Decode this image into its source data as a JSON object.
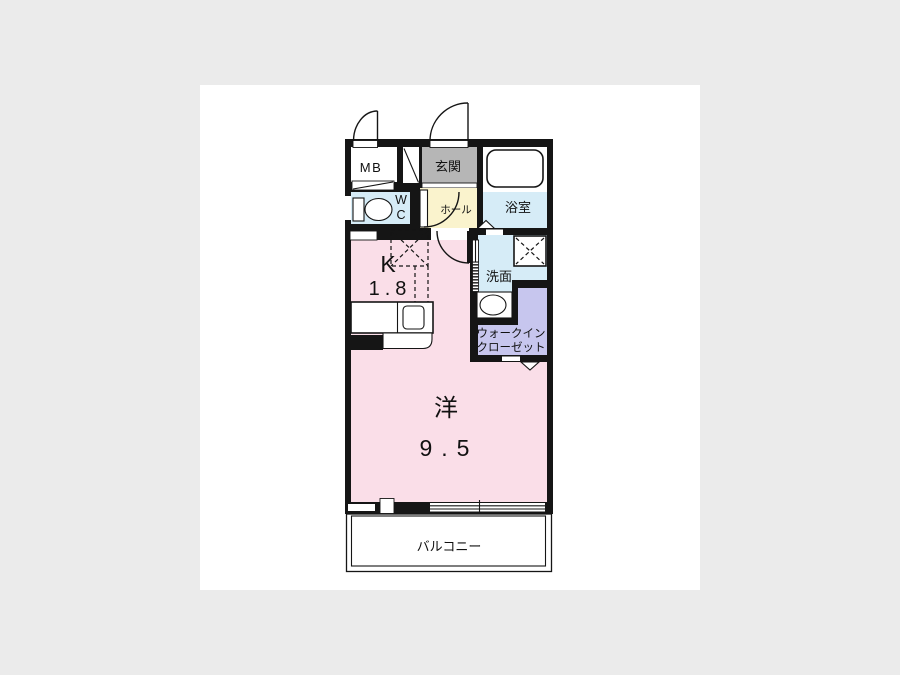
{
  "floorplan": {
    "labels": {
      "mb": "MB",
      "entrance": "玄関",
      "bathroom": "浴室",
      "toilet_line1": "W",
      "toilet_line2": "C",
      "hall": "ホール",
      "washroom": "洗面",
      "walk_in_closet_line1": "ウォークイン",
      "walk_in_closet_line2": "クローゼット",
      "kitchen": "K",
      "kitchen_size": "1.8",
      "western_room": "洋",
      "western_room_size": "9.5",
      "balcony": "バルコニー"
    },
    "colors": {
      "wall": "#151515",
      "room_pink": "#fadee8",
      "wet_area_blue": "#d6ecf7",
      "hall_yellow": "#faf3cd",
      "entrance_gray": "#b6b6b6",
      "closet_lavender": "#c7c6ee",
      "page_bg": "#ffffff",
      "canvas_bg": "#ebebeb"
    }
  }
}
